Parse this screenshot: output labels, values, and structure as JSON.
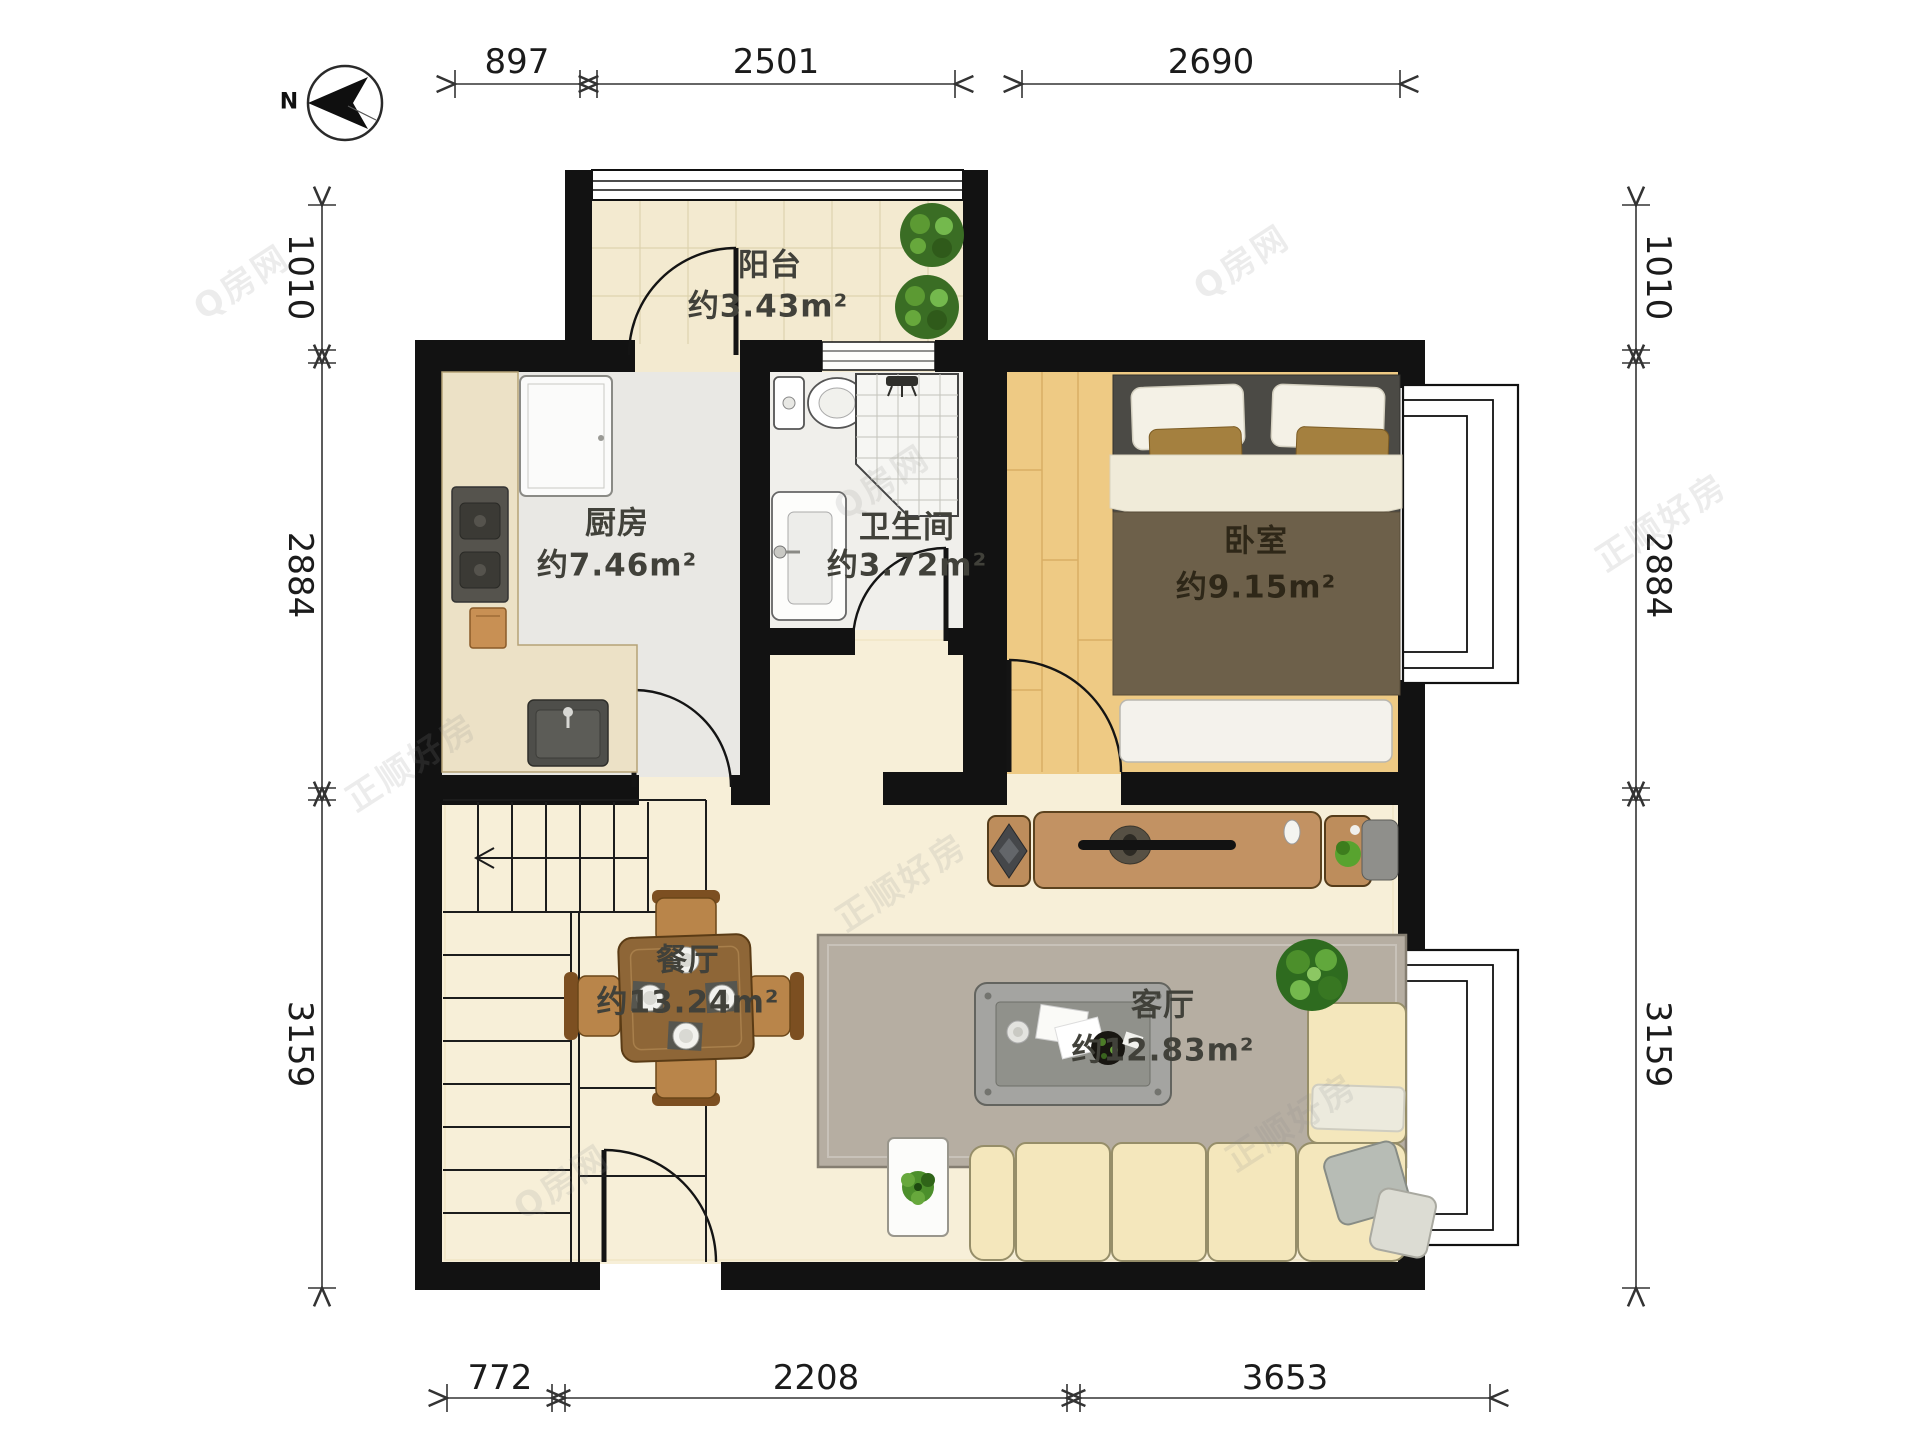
{
  "compass": {
    "label": "N"
  },
  "rooms": {
    "balcony": {
      "name": "阳台",
      "area": "约3.43m²"
    },
    "kitchen": {
      "name": "厨房",
      "area": "约7.46m²"
    },
    "bathroom": {
      "name": "卫生间",
      "area": "约3.72m²"
    },
    "bedroom": {
      "name": "卧室",
      "area": "约9.15m²"
    },
    "dining": {
      "name": "餐厅",
      "area": "约13.24m²"
    },
    "living": {
      "name": "客厅",
      "area": "约12.83m²"
    }
  },
  "dimensions_mm": {
    "top": [
      "897",
      "2501",
      "2690"
    ],
    "bottom": [
      "772",
      "2208",
      "3653"
    ],
    "left": [
      "1010",
      "2884",
      "3159"
    ],
    "right": [
      "1010",
      "2884",
      "3159"
    ]
  },
  "watermarks": [
    "正顺好房",
    "Q房网"
  ],
  "colors": {
    "wall": "#121212",
    "floor_main": "#f7efd8",
    "floor_kitchen": "#e9e8e4",
    "floor_bath": "#f0efeb",
    "floor_wood": "#eeca84",
    "furniture_wood": "#c29263",
    "sofa": "#f4e7bc",
    "plant": "#4c8f2b"
  }
}
